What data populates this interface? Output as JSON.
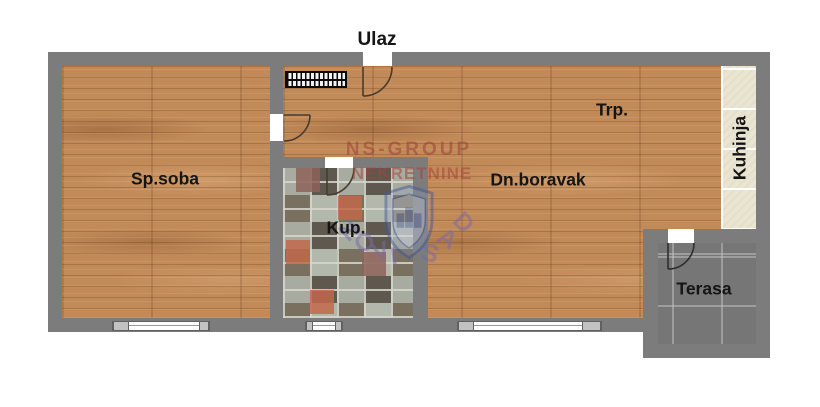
{
  "labels": {
    "entrance": "Ulaz",
    "bedroom": "Sp.soba",
    "bathroom": "Kup.",
    "dining": "Trp.",
    "living": "Dn.boravak",
    "kitchen": "Kuhinja",
    "terrace": "Terasa"
  },
  "watermark": {
    "line1": "NS-GROUP",
    "line2": "NEKRETNINE",
    "arc_text": "NOVI SAD",
    "arc_letters": [
      "N",
      "O",
      "V",
      "I",
      "S",
      "A",
      "D"
    ]
  },
  "colors": {
    "wall": "#7c7c7c",
    "wood_floor": "#c28a58",
    "bathroom_tile_accent": "#c2674a",
    "kitchen_tile": "#eae5d3",
    "terrace_tile": "#767676",
    "window_frame": "#606060",
    "watermark_red": "#9c4038",
    "watermark_blue": "#44589c",
    "watermark_purple": "#7a68a8",
    "label_text": "#151515"
  }
}
